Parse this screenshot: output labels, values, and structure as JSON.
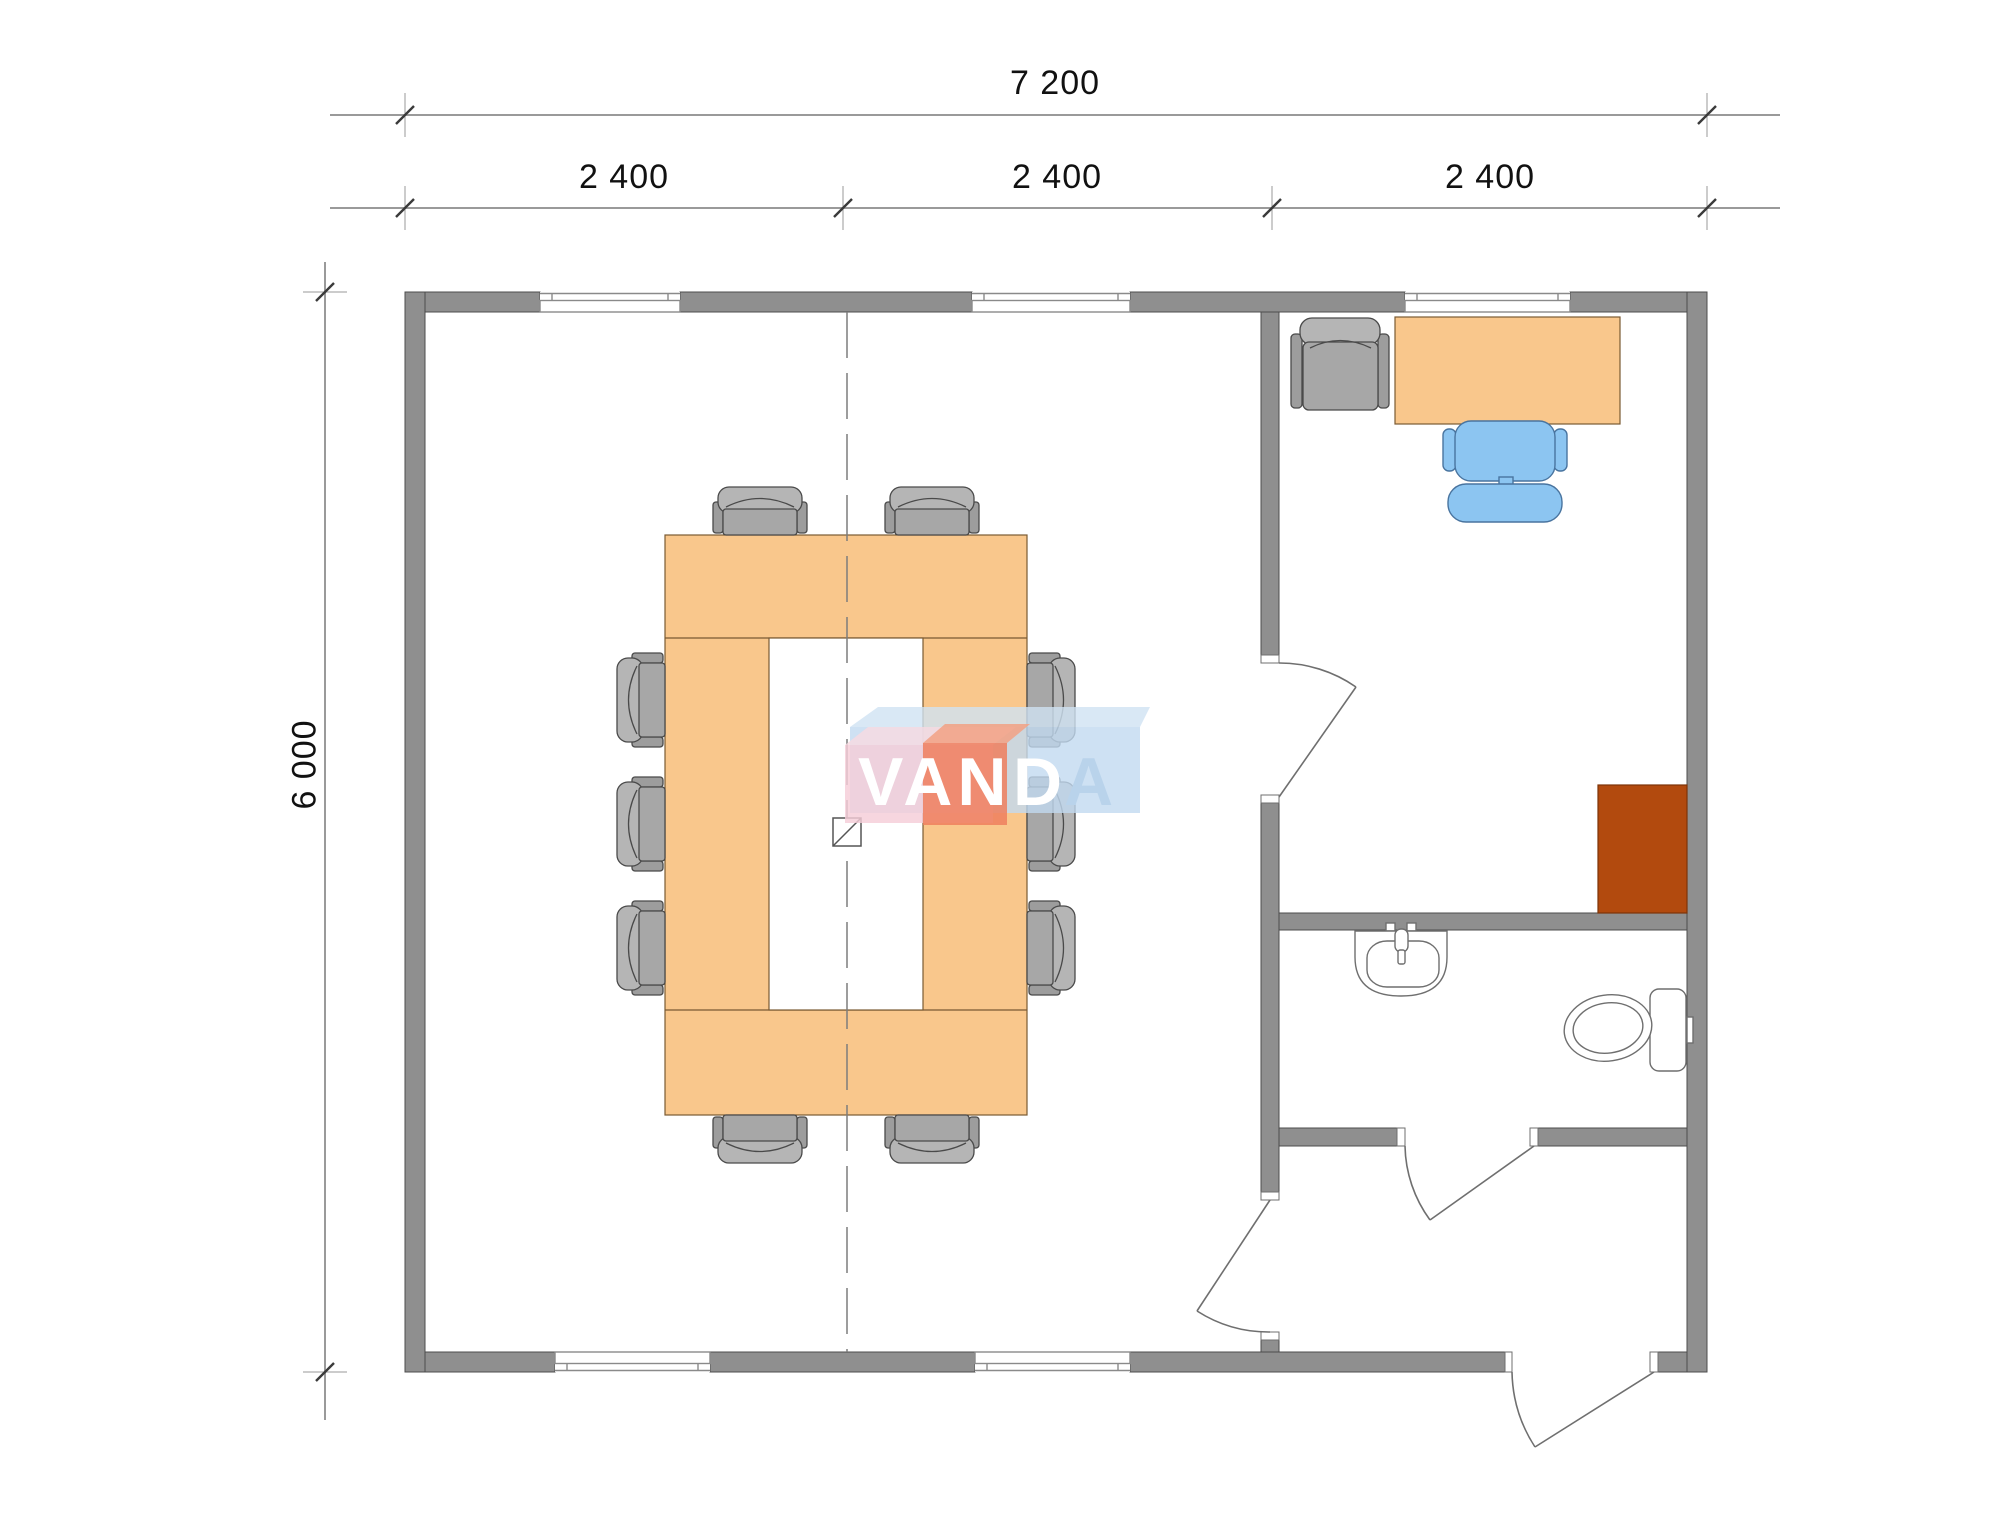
{
  "dimensions": {
    "total_width_label": "7 200",
    "module_labels": [
      "2 400",
      "2 400",
      "2 400"
    ],
    "total_height_label": "6 000"
  },
  "logo": {
    "part_van": "VAN",
    "part_d": "D",
    "part_a": "A"
  },
  "colors": {
    "wall_fill": "#8f8f8f",
    "wall_outline": "#4c4c4c",
    "furniture_wood": "#f9c78c",
    "furniture_wood_outline": "#7a5a33",
    "chair_seat_gray": "#a7a7a7",
    "chair_back_gray": "#b5b5b5",
    "chair_outline": "#4a4a4a",
    "office_chair_blue": "#8cc5f1",
    "office_chair_blue_outline": "#49749f",
    "cabinet_brown": "#b24a0e",
    "fixture_line": "#6f6f6f",
    "dimension_line": "#9a9a9a",
    "dimension_text": "#111111",
    "centerline_gray": "#7d7d7d",
    "logo_blue_top": "#cfe2f2",
    "logo_blue_front": "#c2daf0",
    "logo_pink_top": "#f8dbe2",
    "logo_pink_front": "#f5cdd8",
    "logo_red_top": "#f2a184",
    "logo_red_front": "#ee7f5e",
    "logo_letter_light": "#b9d3eb",
    "logo_letter_white": "#ffffff"
  }
}
